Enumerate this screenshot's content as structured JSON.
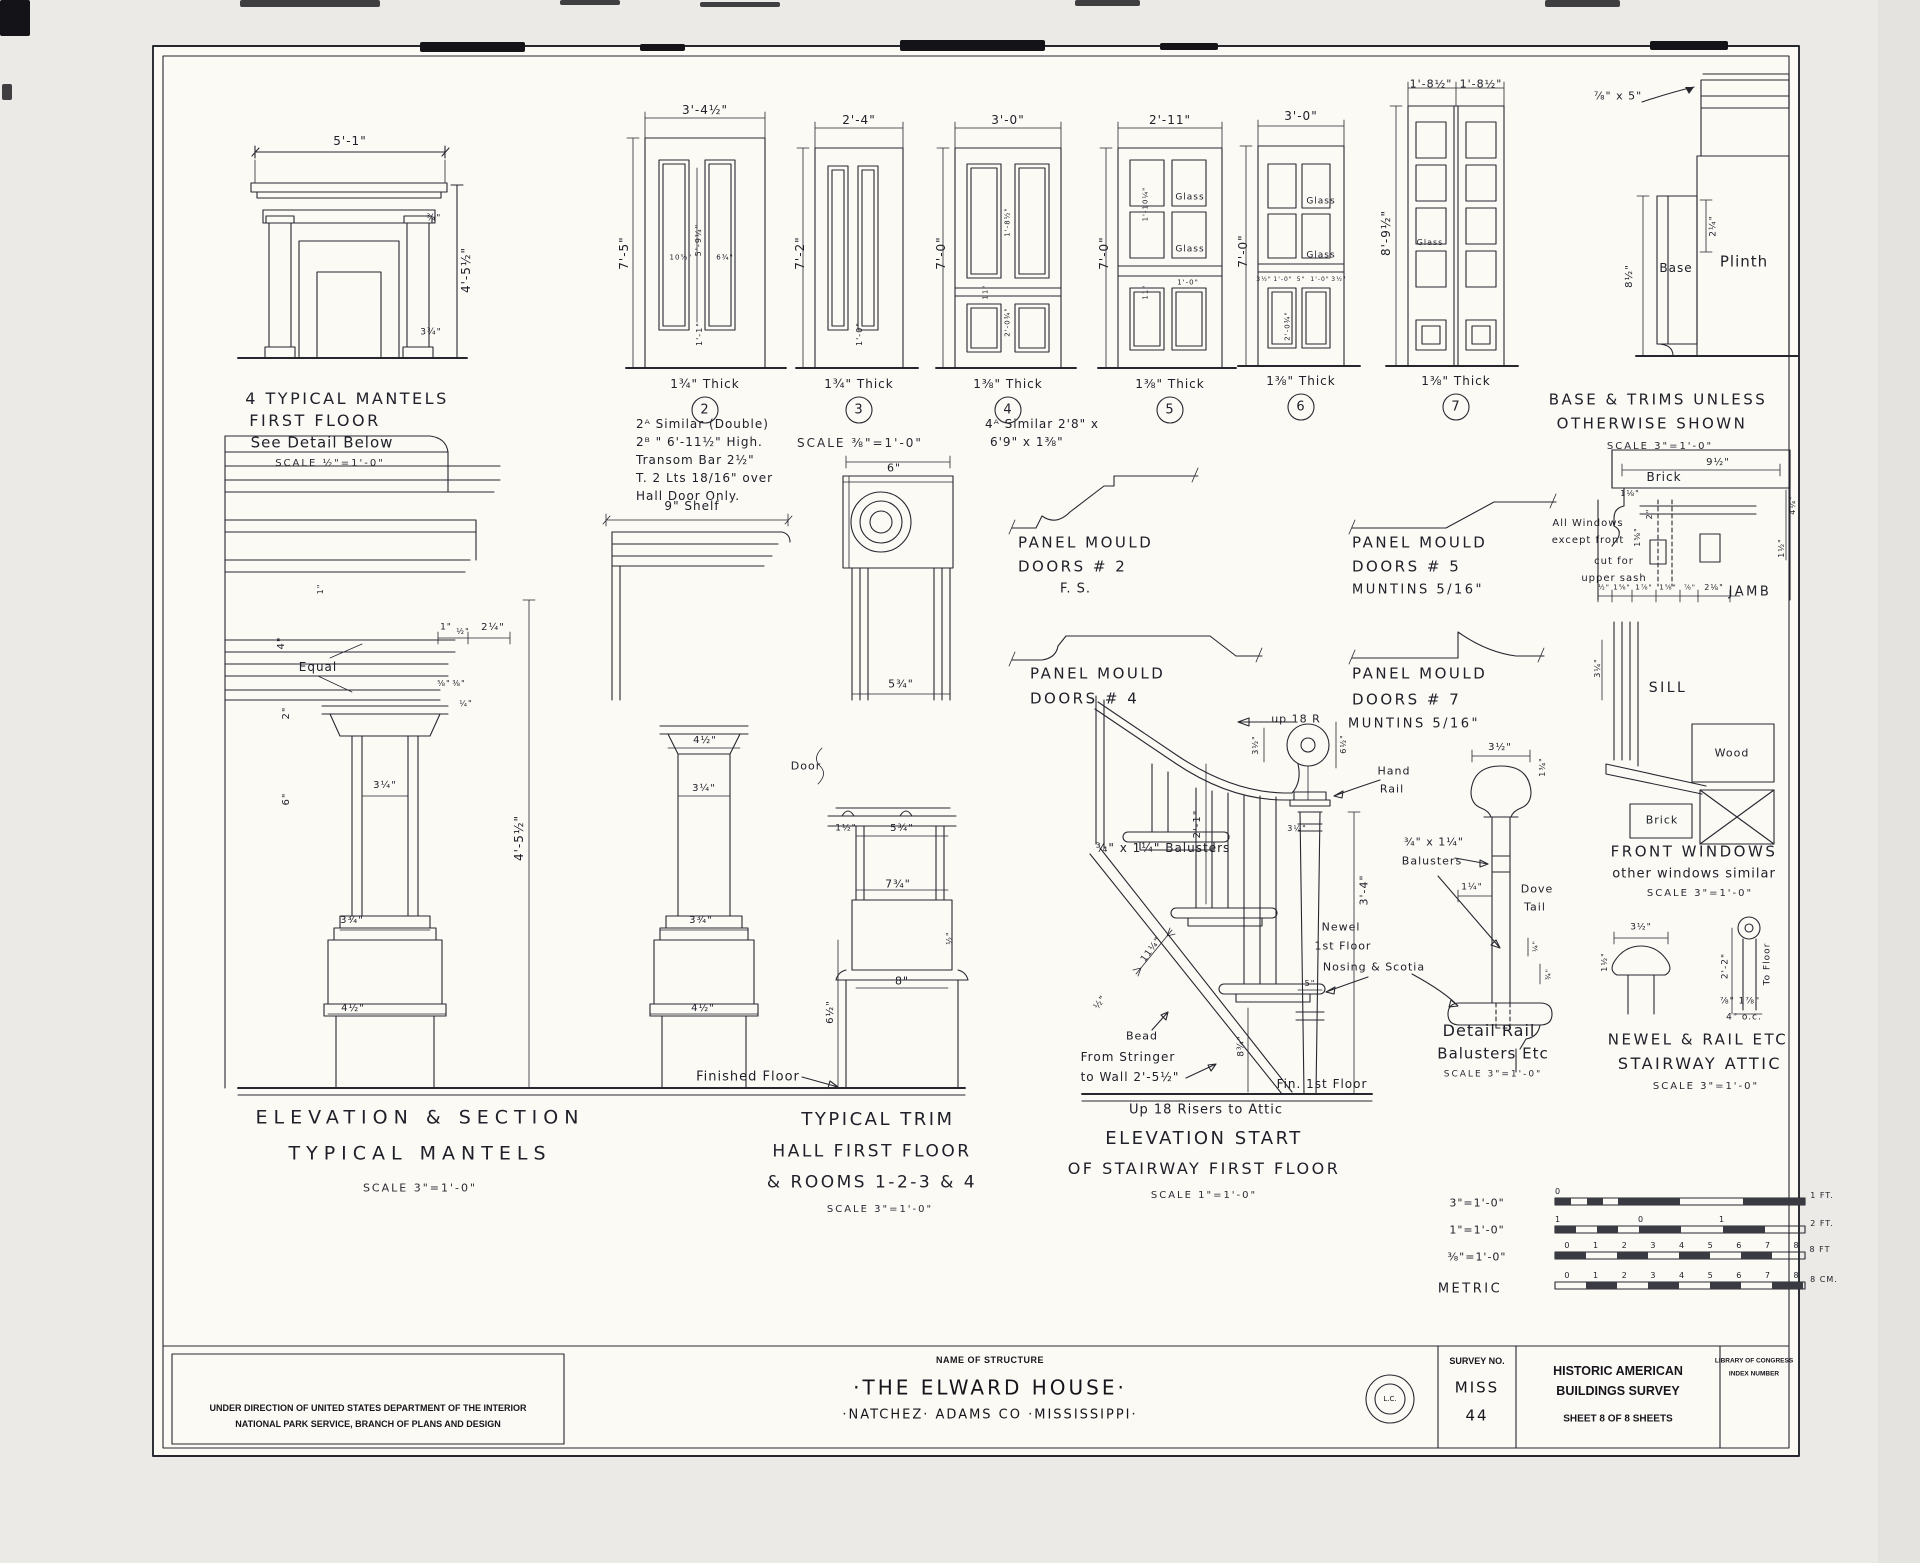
{
  "colors": {
    "ink": "#272730",
    "paper": "#fbfaf5"
  },
  "title_block": {
    "name_label": "NAME OF STRUCTURE",
    "structure_name": "·THE ELWARD HOUSE·",
    "location": "·NATCHEZ·  ADAMS CO ·MISSISSIPPI·",
    "admin_line1": "UNDER DIRECTION OF UNITED STATES DEPARTMENT OF THE INTERIOR",
    "admin_line2": "NATIONAL PARK SERVICE, BRANCH OF PLANS AND DESIGN",
    "survey_label": "SURVEY NO.",
    "survey_state": "MISS",
    "survey_number": "44",
    "habs_line1": "HISTORIC AMERICAN",
    "habs_line2": "BUILDINGS SURVEY",
    "sheet_line": "SHEET 8 OF 8 SHEETS",
    "loc_line1": "LIBRARY OF CONGRESS",
    "loc_line2": "INDEX NUMBER",
    "stamp_center": "L.C."
  },
  "annotations": [
    {
      "t": "5'-1\"",
      "x": 350,
      "y": 141,
      "s": 12
    },
    {
      "t": "4'-5½\"",
      "x": 466,
      "y": 270,
      "s": 12,
      "r": -90
    },
    {
      "t": "¾\"",
      "x": 434,
      "y": 219,
      "s": 9
    },
    {
      "t": "3¾\"",
      "x": 431,
      "y": 333,
      "s": 9
    },
    {
      "t": "4 TYPICAL MANTELS",
      "x": 347,
      "y": 399,
      "s": 16,
      "c": "cap",
      "n": "caption-typical-mantels"
    },
    {
      "t": "FIRST FLOOR",
      "x": 315,
      "y": 421,
      "s": 16,
      "c": "cap"
    },
    {
      "t": "See Detail Below",
      "x": 322,
      "y": 443,
      "s": 15
    },
    {
      "t": "SCALE ½\"=1'-0\"",
      "x": 330,
      "y": 464,
      "s": 10,
      "c": "sc"
    },
    {
      "t": "3'-4½\"",
      "x": 705,
      "y": 110,
      "s": 12
    },
    {
      "t": "7'-5\"",
      "x": 624,
      "y": 253,
      "s": 12,
      "r": -90
    },
    {
      "t": "5'-9¼\"",
      "x": 699,
      "y": 240,
      "s": 8,
      "r": -90
    },
    {
      "t": "10⅝\"",
      "x": 681,
      "y": 258,
      "s": 7
    },
    {
      "t": "6¾\"",
      "x": 725,
      "y": 258,
      "s": 7
    },
    {
      "t": "1'-1\"",
      "x": 700,
      "y": 334,
      "s": 8,
      "r": -90
    },
    {
      "t": "1¾\" Thick",
      "x": 705,
      "y": 384,
      "s": 12
    },
    {
      "t": "2",
      "x": 705,
      "y": 410,
      "s": 13,
      "n": "door-number-2"
    },
    {
      "t": "2ᴬ Similar (Double)",
      "x": 636,
      "y": 424,
      "s": 12,
      "a": "l"
    },
    {
      "t": "2ᴮ   \"   6'-11½\" High.",
      "x": 636,
      "y": 442,
      "s": 12,
      "a": "l"
    },
    {
      "t": "Transom Bar 2½\"",
      "x": 636,
      "y": 460,
      "s": 12,
      "a": "l"
    },
    {
      "t": "T. 2 Lts 18/16\" over",
      "x": 636,
      "y": 478,
      "s": 12,
      "a": "l"
    },
    {
      "t": "Hall Door Only.",
      "x": 636,
      "y": 496,
      "s": 12,
      "a": "l"
    },
    {
      "t": "2'-4\"",
      "x": 859,
      "y": 120,
      "s": 12
    },
    {
      "t": "7'-2\"",
      "x": 800,
      "y": 253,
      "s": 12,
      "r": -90
    },
    {
      "t": "1'-0\"",
      "x": 860,
      "y": 334,
      "s": 8,
      "r": -90
    },
    {
      "t": "1¾\" Thick",
      "x": 859,
      "y": 384,
      "s": 12
    },
    {
      "t": "3",
      "x": 859,
      "y": 410,
      "s": 13,
      "n": "door-number-3"
    },
    {
      "t": "SCALE ⅜\"=1'-0\"",
      "x": 860,
      "y": 443,
      "s": 12,
      "c": "sc"
    },
    {
      "t": "3'-0\"",
      "x": 1008,
      "y": 120,
      "s": 12
    },
    {
      "t": "7'-0\"",
      "x": 941,
      "y": 253,
      "s": 12,
      "r": -90
    },
    {
      "t": "1'-8½\"",
      "x": 1008,
      "y": 222,
      "s": 7,
      "r": -90
    },
    {
      "t": "11\"",
      "x": 986,
      "y": 292,
      "s": 7,
      "r": -90
    },
    {
      "t": "2'-0¾\"",
      "x": 1008,
      "y": 322,
      "s": 7,
      "r": -90
    },
    {
      "t": "1⅜\" Thick",
      "x": 1008,
      "y": 384,
      "s": 12
    },
    {
      "t": "4",
      "x": 1008,
      "y": 410,
      "s": 13,
      "n": "door-number-4"
    },
    {
      "t": "4ᴬ Similar 2'8\" x",
      "x": 985,
      "y": 424,
      "s": 12,
      "a": "l"
    },
    {
      "t": "6'9\" x 1⅜\"",
      "x": 990,
      "y": 442,
      "s": 12,
      "a": "l"
    },
    {
      "t": "2'-11\"",
      "x": 1170,
      "y": 120,
      "s": 12
    },
    {
      "t": "7'-0\"",
      "x": 1104,
      "y": 253,
      "s": 12,
      "r": -90
    },
    {
      "t": "Glass",
      "x": 1190,
      "y": 198,
      "s": 9
    },
    {
      "t": "Glass",
      "x": 1190,
      "y": 250,
      "s": 9
    },
    {
      "t": "1'-10¼\"",
      "x": 1146,
      "y": 204,
      "s": 7,
      "r": -90
    },
    {
      "t": "11\"",
      "x": 1146,
      "y": 292,
      "s": 7,
      "r": -90
    },
    {
      "t": "1'-0\"",
      "x": 1188,
      "y": 283,
      "s": 7
    },
    {
      "t": "1⅜\" Thick",
      "x": 1170,
      "y": 384,
      "s": 12
    },
    {
      "t": "5",
      "x": 1170,
      "y": 410,
      "s": 13,
      "n": "door-number-5"
    },
    {
      "t": "3'-0\"",
      "x": 1301,
      "y": 116,
      "s": 12
    },
    {
      "t": "7'-0\"",
      "x": 1243,
      "y": 251,
      "s": 12,
      "r": -90
    },
    {
      "t": "Glass",
      "x": 1321,
      "y": 202,
      "s": 9
    },
    {
      "t": "Glass",
      "x": 1321,
      "y": 256,
      "s": 9
    },
    {
      "t": "3½\"",
      "x": 1264,
      "y": 280,
      "s": 6
    },
    {
      "t": "1'-0\"",
      "x": 1283,
      "y": 280,
      "s": 6
    },
    {
      "t": "5\"",
      "x": 1301,
      "y": 280,
      "s": 6
    },
    {
      "t": "1'-0\"",
      "x": 1320,
      "y": 280,
      "s": 6
    },
    {
      "t": "3½\"",
      "x": 1339,
      "y": 280,
      "s": 6
    },
    {
      "t": "2'-0¾\"",
      "x": 1288,
      "y": 326,
      "s": 7,
      "r": -90
    },
    {
      "t": "1⅜\" Thick",
      "x": 1301,
      "y": 381,
      "s": 12
    },
    {
      "t": "6",
      "x": 1301,
      "y": 407,
      "s": 13,
      "n": "door-number-6"
    },
    {
      "t": "1'-8½\"",
      "x": 1431,
      "y": 84,
      "s": 11
    },
    {
      "t": "1'-8½\"",
      "x": 1481,
      "y": 84,
      "s": 11
    },
    {
      "t": "8'-9½\"",
      "x": 1386,
      "y": 233,
      "s": 12,
      "r": -90
    },
    {
      "t": "Glass",
      "x": 1430,
      "y": 243,
      "s": 8
    },
    {
      "t": "1⅜\" Thick",
      "x": 1456,
      "y": 381,
      "s": 12
    },
    {
      "t": "7",
      "x": 1456,
      "y": 407,
      "s": 13,
      "n": "door-number-7"
    },
    {
      "t": "⅞\" x 5\"",
      "x": 1618,
      "y": 96,
      "s": 11
    },
    {
      "t": "8½\"",
      "x": 1630,
      "y": 276,
      "s": 10,
      "r": -90
    },
    {
      "t": "2¼\"",
      "x": 1714,
      "y": 226,
      "s": 9,
      "r": -90
    },
    {
      "t": "Base",
      "x": 1676,
      "y": 268,
      "s": 12
    },
    {
      "t": "Plinth",
      "x": 1744,
      "y": 262,
      "s": 15
    },
    {
      "t": "BASE & TRIMS UNLESS",
      "x": 1658,
      "y": 400,
      "s": 15,
      "c": "cap",
      "n": "caption-base-trims"
    },
    {
      "t": "OTHERWISE SHOWN",
      "x": 1652,
      "y": 424,
      "s": 15,
      "c": "cap"
    },
    {
      "t": "SCALE 3\"=1'-0\"",
      "x": 1660,
      "y": 447,
      "s": 10,
      "c": "sc"
    },
    {
      "t": "9\" Shelf",
      "x": 692,
      "y": 506,
      "s": 12
    },
    {
      "t": "Equal",
      "x": 318,
      "y": 667,
      "s": 12
    },
    {
      "t": "4\"",
      "x": 282,
      "y": 643,
      "s": 10,
      "r": -90
    },
    {
      "t": "2\"",
      "x": 287,
      "y": 713,
      "s": 10,
      "r": -90
    },
    {
      "t": "6\"",
      "x": 287,
      "y": 799,
      "s": 10,
      "r": -90
    },
    {
      "t": "1\"",
      "x": 321,
      "y": 589,
      "s": 8,
      "r": -90
    },
    {
      "t": "1\"",
      "x": 446,
      "y": 628,
      "s": 9
    },
    {
      "t": "½\"",
      "x": 463,
      "y": 632,
      "s": 8
    },
    {
      "t": "2¼\"",
      "x": 493,
      "y": 628,
      "s": 10
    },
    {
      "t": "⅝\"",
      "x": 444,
      "y": 684,
      "s": 8
    },
    {
      "t": "⅜\"",
      "x": 459,
      "y": 684,
      "s": 8
    },
    {
      "t": "¼\"",
      "x": 466,
      "y": 704,
      "s": 8
    },
    {
      "t": "3¼\"",
      "x": 385,
      "y": 786,
      "s": 10
    },
    {
      "t": "3¾\"",
      "x": 352,
      "y": 921,
      "s": 10
    },
    {
      "t": "4½\"",
      "x": 353,
      "y": 1009,
      "s": 10
    },
    {
      "t": "4'-5½\"",
      "x": 519,
      "y": 838,
      "s": 12,
      "r": -90
    },
    {
      "t": "4½\"",
      "x": 705,
      "y": 741,
      "s": 10
    },
    {
      "t": "3¼\"",
      "x": 704,
      "y": 789,
      "s": 10
    },
    {
      "t": "3¾\"",
      "x": 701,
      "y": 921,
      "s": 10
    },
    {
      "t": "4½\"",
      "x": 703,
      "y": 1009,
      "s": 10
    },
    {
      "t": "ELEVATION    &    SECTION",
      "x": 420,
      "y": 1118,
      "s": 19,
      "c": "cap2",
      "n": "caption-elevation-section"
    },
    {
      "t": "TYPICAL    MANTELS",
      "x": 420,
      "y": 1154,
      "s": 19,
      "c": "cap2"
    },
    {
      "t": "SCALE  3\"=1'-0\"",
      "x": 420,
      "y": 1188,
      "s": 11,
      "c": "sc"
    },
    {
      "t": "6\"",
      "x": 894,
      "y": 468,
      "s": 11
    },
    {
      "t": "5¾\"",
      "x": 901,
      "y": 684,
      "s": 11
    },
    {
      "t": "Door",
      "x": 806,
      "y": 766,
      "s": 11
    },
    {
      "t": "1½\"",
      "x": 846,
      "y": 829,
      "s": 9
    },
    {
      "t": "5¾\"",
      "x": 902,
      "y": 829,
      "s": 10
    },
    {
      "t": "7¾\"",
      "x": 898,
      "y": 884,
      "s": 11
    },
    {
      "t": "8\"",
      "x": 902,
      "y": 981,
      "s": 11
    },
    {
      "t": "6½\"",
      "x": 831,
      "y": 1012,
      "s": 10,
      "r": -90
    },
    {
      "t": "½\"",
      "x": 950,
      "y": 938,
      "s": 8,
      "r": -90
    },
    {
      "t": "Finished Floor",
      "x": 748,
      "y": 1077,
      "s": 13
    },
    {
      "t": "TYPICAL TRIM",
      "x": 878,
      "y": 1120,
      "s": 18,
      "c": "cap",
      "n": "caption-typical-trim"
    },
    {
      "t": "HALL FIRST FLOOR",
      "x": 872,
      "y": 1152,
      "s": 17,
      "c": "cap"
    },
    {
      "t": "& ROOMS 1-2-3 & 4",
      "x": 872,
      "y": 1183,
      "s": 17,
      "c": "cap"
    },
    {
      "t": "SCALE 3\"=1'-0\"",
      "x": 880,
      "y": 1210,
      "s": 10,
      "c": "sc"
    },
    {
      "t": "PANEL MOULD",
      "x": 1018,
      "y": 543,
      "s": 15,
      "a": "l",
      "c": "cap",
      "n": "caption-panel-mould-2"
    },
    {
      "t": "DOORS # 2",
      "x": 1018,
      "y": 567,
      "s": 15,
      "a": "l",
      "c": "cap"
    },
    {
      "t": "F. S.",
      "x": 1060,
      "y": 589,
      "s": 13,
      "a": "l"
    },
    {
      "t": "PANEL MOULD",
      "x": 1352,
      "y": 543,
      "s": 15,
      "a": "l",
      "c": "cap",
      "n": "caption-panel-mould-5"
    },
    {
      "t": "DOORS # 5",
      "x": 1352,
      "y": 567,
      "s": 15,
      "a": "l",
      "c": "cap"
    },
    {
      "t": "MUNTINS 5/16\"",
      "x": 1352,
      "y": 590,
      "s": 13,
      "a": "l",
      "c": "cap"
    },
    {
      "t": "PANEL MOULD",
      "x": 1030,
      "y": 674,
      "s": 15,
      "a": "l",
      "c": "cap",
      "n": "caption-panel-mould-4"
    },
    {
      "t": "DOORS # 4",
      "x": 1030,
      "y": 699,
      "s": 15,
      "a": "l",
      "c": "cap"
    },
    {
      "t": "PANEL MOULD",
      "x": 1352,
      "y": 674,
      "s": 15,
      "a": "l",
      "c": "cap",
      "n": "caption-panel-mould-7"
    },
    {
      "t": "DOORS # 7",
      "x": 1352,
      "y": 700,
      "s": 15,
      "a": "l",
      "c": "cap"
    },
    {
      "t": "MUNTINS 5/16\"",
      "x": 1348,
      "y": 724,
      "s": 13,
      "a": "l",
      "c": "cap"
    },
    {
      "t": "up 18 R",
      "x": 1296,
      "y": 719,
      "s": 11
    },
    {
      "t": "3½\"",
      "x": 1256,
      "y": 745,
      "s": 8,
      "r": -90
    },
    {
      "t": "6½\"",
      "x": 1344,
      "y": 744,
      "s": 8,
      "r": -90
    },
    {
      "t": "Hand",
      "x": 1394,
      "y": 771,
      "s": 11
    },
    {
      "t": "Rail",
      "x": 1392,
      "y": 789,
      "s": 11
    },
    {
      "t": "2'-1\"",
      "x": 1198,
      "y": 824,
      "s": 10,
      "r": -90
    },
    {
      "t": "¾\" x 1¼\" Balusters",
      "x": 1163,
      "y": 848,
      "s": 12
    },
    {
      "t": "3¼\"",
      "x": 1297,
      "y": 829,
      "s": 8
    },
    {
      "t": "3'-4\"",
      "x": 1364,
      "y": 890,
      "s": 11,
      "r": -90
    },
    {
      "t": "Newel",
      "x": 1341,
      "y": 927,
      "s": 11
    },
    {
      "t": "1st Floor",
      "x": 1343,
      "y": 946,
      "s": 11
    },
    {
      "t": "Nosing & Scotia",
      "x": 1374,
      "y": 967,
      "s": 11
    },
    {
      "t": "5\"",
      "x": 1310,
      "y": 984,
      "s": 8
    },
    {
      "t": "11¼\"",
      "x": 1152,
      "y": 950,
      "s": 9,
      "r": -54
    },
    {
      "t": "½\"",
      "x": 1101,
      "y": 1003,
      "s": 9,
      "r": -54
    },
    {
      "t": "Bead",
      "x": 1142,
      "y": 1036,
      "s": 11
    },
    {
      "t": "From Stringer",
      "x": 1128,
      "y": 1057,
      "s": 12
    },
    {
      "t": "to Wall 2'-5½\"",
      "x": 1130,
      "y": 1077,
      "s": 12
    },
    {
      "t": "8¾\"",
      "x": 1242,
      "y": 1046,
      "s": 9,
      "r": -90
    },
    {
      "t": "Fin. 1st Floor",
      "x": 1322,
      "y": 1084,
      "s": 12
    },
    {
      "t": "Up 18 Risers to Attic",
      "x": 1206,
      "y": 1110,
      "s": 13
    },
    {
      "t": "ELEVATION START",
      "x": 1204,
      "y": 1139,
      "s": 18,
      "c": "cap",
      "n": "caption-elevation-start"
    },
    {
      "t": "OF STAIRWAY FIRST FLOOR",
      "x": 1204,
      "y": 1169,
      "s": 16,
      "c": "cap"
    },
    {
      "t": "SCALE  1\"=1'-0\"",
      "x": 1204,
      "y": 1196,
      "s": 10,
      "c": "sc"
    },
    {
      "t": "3½\"",
      "x": 1500,
      "y": 748,
      "s": 10
    },
    {
      "t": "1¾\"",
      "x": 1543,
      "y": 767,
      "s": 8,
      "r": -90
    },
    {
      "t": "¾\" x 1¼\"",
      "x": 1434,
      "y": 842,
      "s": 11
    },
    {
      "t": "Balusters",
      "x": 1432,
      "y": 861,
      "s": 11
    },
    {
      "t": "Dove",
      "x": 1537,
      "y": 889,
      "s": 11
    },
    {
      "t": "Tail",
      "x": 1535,
      "y": 907,
      "s": 11
    },
    {
      "t": "1¼\"",
      "x": 1472,
      "y": 888,
      "s": 9
    },
    {
      "t": "¼\"",
      "x": 1536,
      "y": 946,
      "s": 7,
      "r": -90
    },
    {
      "t": "¾\"",
      "x": 1549,
      "y": 974,
      "s": 7,
      "r": -90
    },
    {
      "t": "Detail Rail",
      "x": 1489,
      "y": 1031,
      "s": 16,
      "n": "caption-detail-rail"
    },
    {
      "t": "Balusters Etc",
      "x": 1493,
      "y": 1054,
      "s": 15
    },
    {
      "t": "SCALE 3\"=1'-0\"",
      "x": 1493,
      "y": 1075,
      "s": 9,
      "c": "sc"
    },
    {
      "t": "Brick",
      "x": 1664,
      "y": 477,
      "s": 12,
      "c": "bg"
    },
    {
      "t": "9½\"",
      "x": 1718,
      "y": 463,
      "s": 10,
      "c": "bg"
    },
    {
      "t": "1⅛\"",
      "x": 1630,
      "y": 494,
      "s": 8
    },
    {
      "t": "2\"",
      "x": 1650,
      "y": 514,
      "s": 8,
      "r": -90
    },
    {
      "t": "1⅝\"",
      "x": 1638,
      "y": 537,
      "s": 8,
      "r": -90
    },
    {
      "t": "All Windows",
      "x": 1588,
      "y": 524,
      "s": 10
    },
    {
      "t": "except front",
      "x": 1588,
      "y": 541,
      "s": 10
    },
    {
      "t": "cut for",
      "x": 1614,
      "y": 562,
      "s": 10
    },
    {
      "t": "upper sash",
      "x": 1614,
      "y": 579,
      "s": 10
    },
    {
      "t": "½\"",
      "x": 1604,
      "y": 588,
      "s": 7
    },
    {
      "t": "1⅝\"",
      "x": 1622,
      "y": 588,
      "s": 7
    },
    {
      "t": "1⅞\"",
      "x": 1644,
      "y": 588,
      "s": 7
    },
    {
      "t": "1⅝\"",
      "x": 1668,
      "y": 588,
      "s": 7
    },
    {
      "t": "⅞\"",
      "x": 1690,
      "y": 588,
      "s": 7
    },
    {
      "t": "2⅛\"",
      "x": 1714,
      "y": 588,
      "s": 8
    },
    {
      "t": "JAMB",
      "x": 1750,
      "y": 592,
      "s": 13,
      "c": "cap"
    },
    {
      "t": "1½\"",
      "x": 1782,
      "y": 548,
      "s": 8,
      "r": -90
    },
    {
      "t": "4¼\"",
      "x": 1793,
      "y": 505,
      "s": 8,
      "r": -90
    },
    {
      "t": "SILL",
      "x": 1668,
      "y": 688,
      "s": 14,
      "c": "cap"
    },
    {
      "t": "3¼\"",
      "x": 1598,
      "y": 668,
      "s": 8,
      "r": -90
    },
    {
      "t": "Wood",
      "x": 1732,
      "y": 753,
      "s": 11
    },
    {
      "t": "Brick",
      "x": 1662,
      "y": 820,
      "s": 11,
      "c": "bg"
    },
    {
      "t": "FRONT WINDOWS",
      "x": 1694,
      "y": 852,
      "s": 15,
      "c": "cap",
      "n": "caption-front-windows"
    },
    {
      "t": "other windows similar",
      "x": 1694,
      "y": 874,
      "s": 13
    },
    {
      "t": "SCALE 3\"=1'-0\"",
      "x": 1700,
      "y": 894,
      "s": 10,
      "c": "sc"
    },
    {
      "t": "3½\"",
      "x": 1641,
      "y": 928,
      "s": 9
    },
    {
      "t": "1½\"",
      "x": 1605,
      "y": 962,
      "s": 8,
      "r": -90
    },
    {
      "t": "2'-2\"",
      "x": 1726,
      "y": 966,
      "s": 9,
      "r": -90
    },
    {
      "t": "To Floor",
      "x": 1768,
      "y": 964,
      "s": 9,
      "r": -90
    },
    {
      "t": "⅞\" 1⅞\"",
      "x": 1740,
      "y": 1002,
      "s": 9
    },
    {
      "t": "4\" o.c.",
      "x": 1744,
      "y": 1018,
      "s": 9
    },
    {
      "t": "NEWEL & RAIL ETC",
      "x": 1698,
      "y": 1040,
      "s": 15,
      "c": "cap",
      "n": "caption-newel-rail"
    },
    {
      "t": "STAIRWAY ATTIC",
      "x": 1700,
      "y": 1064,
      "s": 16,
      "c": "cap"
    },
    {
      "t": "SCALE 3\"=1'-0\"",
      "x": 1706,
      "y": 1087,
      "s": 10,
      "c": "sc"
    },
    {
      "t": "3\"=1'-0\"",
      "x": 1477,
      "y": 1203,
      "s": 11
    },
    {
      "t": "1\"=1'-0\"",
      "x": 1477,
      "y": 1230,
      "s": 11
    },
    {
      "t": "⅜\"=1'-0\"",
      "x": 1477,
      "y": 1257,
      "s": 11
    },
    {
      "t": "METRIC",
      "x": 1470,
      "y": 1289,
      "s": 13,
      "c": "cap"
    },
    {
      "t": "0",
      "x": 1558,
      "y": 1192,
      "s": 8
    },
    {
      "t": "1 FT.",
      "x": 1822,
      "y": 1196,
      "s": 8
    },
    {
      "t": "1",
      "x": 1558,
      "y": 1220,
      "s": 8
    },
    {
      "t": "0",
      "x": 1641,
      "y": 1220,
      "s": 8
    },
    {
      "t": "1",
      "x": 1722,
      "y": 1220,
      "s": 8
    },
    {
      "t": "2 FT.",
      "x": 1822,
      "y": 1224,
      "s": 8
    },
    {
      "t": "0 1 2 3 4 5 6 7 8",
      "x": 1682,
      "y": 1246,
      "s": 8,
      "c": "spread"
    },
    {
      "t": "8 FT",
      "x": 1820,
      "y": 1250,
      "s": 8
    },
    {
      "t": "0 1 2 3 4 5 6 7 8",
      "x": 1682,
      "y": 1276,
      "s": 8,
      "c": "spread"
    },
    {
      "t": "8 CM.",
      "x": 1824,
      "y": 1280,
      "s": 8
    }
  ]
}
